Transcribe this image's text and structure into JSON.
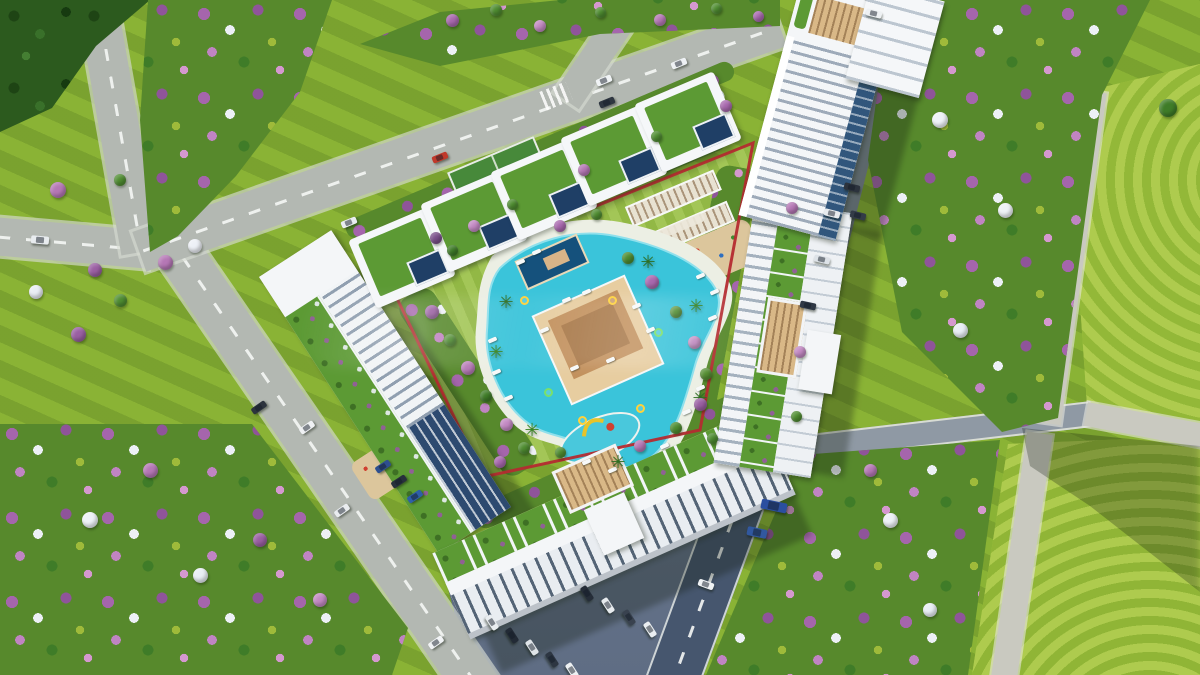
{
  "scene": {
    "type": "aerial-architectural-render",
    "label": "Bird's-eye 3D render of a triangular residential complex: a red property boundary encloses a landscaped garden with a free-form turquoise pool, pool bar, sports court, pergolas and playgrounds; a row of villas with green roofs lines the north-west edge, three white apartment blocks with roof gardens frame the site, a high-rise tower stands at the top right, all surrounded by roads with cars and fields of purple, pink, white and green flowering trees",
    "watermark_visible": true
  },
  "palette": {
    "lawn": "#8ab335",
    "lawn_sunlit": "#a8c944",
    "road": "#b3b8b2",
    "road_shaded": "#46566e",
    "path": "#c9c9c0",
    "building_white": "#f4f6f8",
    "glass_blue": "#2d4a70",
    "roof_garden": "#5c9a34",
    "pool": "#3ac4da",
    "deck_tan": "#d9b887",
    "boundary_red": "#b42b30",
    "tree_green": "#4f8d31",
    "tree_purple": "#9a5fa2",
    "tree_pink": "#c389c3",
    "tree_white": "#edf0f6"
  },
  "sprites": {
    "groups": [
      {
        "name": "car",
        "class": "car",
        "host": "#sprite-layer",
        "w": 16,
        "h": 7,
        "items": [
          {
            "x": 440,
            "y": 157,
            "r": -22,
            "c": "#c0392b"
          },
          {
            "x": 349,
            "y": 222,
            "r": -22,
            "c": "#e9edf0"
          },
          {
            "x": 604,
            "y": 80,
            "r": -22,
            "c": "#f0f3f5"
          },
          {
            "x": 607,
            "y": 102,
            "r": -22,
            "c": "#2e3640"
          },
          {
            "x": 679,
            "y": 63,
            "r": -22,
            "c": "#eef1f4"
          },
          {
            "x": 40,
            "y": 240,
            "r": 5,
            "c": "#e8ecef",
            "w": 18,
            "h": 8
          },
          {
            "x": 259,
            "y": 407,
            "r": -35,
            "c": "#2c333d"
          },
          {
            "x": 307,
            "y": 427,
            "r": -35,
            "c": "#eff1f3"
          },
          {
            "x": 342,
            "y": 510,
            "r": -35,
            "c": "#e9ecef"
          },
          {
            "x": 436,
            "y": 642,
            "r": -35,
            "c": "#f1f3f5"
          },
          {
            "x": 874,
            "y": 13,
            "r": 14,
            "c": "#eef1f3"
          },
          {
            "x": 852,
            "y": 187,
            "r": 14,
            "c": "#2c333d"
          },
          {
            "x": 858,
            "y": 215,
            "r": 14,
            "c": "#333b47"
          },
          {
            "x": 832,
            "y": 213,
            "r": 14,
            "c": "#e8ebee"
          },
          {
            "x": 822,
            "y": 259,
            "r": 13,
            "c": "#dde2e7"
          },
          {
            "x": 808,
            "y": 305,
            "r": 12,
            "c": "#2f3845"
          },
          {
            "x": 706,
            "y": 584,
            "r": 20,
            "c": "#eff2f4"
          },
          {
            "x": 774,
            "y": 506,
            "r": 12,
            "c": "#2b4fa0",
            "w": 26,
            "h": 10
          },
          {
            "x": 757,
            "y": 532,
            "r": 12,
            "c": "#31589f",
            "w": 20,
            "h": 9
          },
          {
            "x": 492,
            "y": 622,
            "r": 57,
            "c": "#e9edf0"
          },
          {
            "x": 512,
            "y": 635,
            "r": 57,
            "c": "#222a35"
          },
          {
            "x": 532,
            "y": 647,
            "r": 57,
            "c": "#dfe4e8"
          },
          {
            "x": 552,
            "y": 659,
            "r": 57,
            "c": "#2d3642"
          },
          {
            "x": 572,
            "y": 670,
            "r": 57,
            "c": "#eef1f3"
          },
          {
            "x": 587,
            "y": 593,
            "r": 57,
            "c": "#252d38"
          },
          {
            "x": 608,
            "y": 605,
            "r": 57,
            "c": "#e7ebee"
          },
          {
            "x": 629,
            "y": 617,
            "r": 57,
            "c": "#39424f"
          },
          {
            "x": 650,
            "y": 629,
            "r": 57,
            "c": "#eaeef1"
          },
          {
            "x": 383,
            "y": 466,
            "r": -33,
            "c": "#2e4f8f"
          },
          {
            "x": 399,
            "y": 481,
            "r": -33,
            "c": "#27303c"
          },
          {
            "x": 415,
            "y": 496,
            "r": -33,
            "c": "#2e5fa8"
          }
        ]
      },
      {
        "name": "lounger",
        "class": "lounger",
        "host": "#sprite-layer",
        "w": 9,
        "h": 4,
        "r": -24,
        "items": [
          {
            "x": 520,
            "y": 262
          },
          {
            "x": 536,
            "y": 252
          },
          {
            "x": 700,
            "y": 276
          },
          {
            "x": 714,
            "y": 292
          },
          {
            "x": 712,
            "y": 318
          },
          {
            "x": 700,
            "y": 388
          },
          {
            "x": 686,
            "y": 412
          },
          {
            "x": 664,
            "y": 446
          },
          {
            "x": 612,
            "y": 470
          },
          {
            "x": 586,
            "y": 462
          },
          {
            "x": 508,
            "y": 398
          },
          {
            "x": 496,
            "y": 372
          },
          {
            "x": 492,
            "y": 340
          },
          {
            "x": 566,
            "y": 300
          },
          {
            "x": 586,
            "y": 292
          },
          {
            "x": 636,
            "y": 306
          },
          {
            "x": 650,
            "y": 330
          },
          {
            "x": 610,
            "y": 360
          },
          {
            "x": 574,
            "y": 368
          },
          {
            "x": 544,
            "y": 330
          }
        ]
      },
      {
        "name": "pool-float",
        "class": "float",
        "host": "#sprite-layer",
        "w": 9,
        "h": 9,
        "prop": "border",
        "items": [
          {
            "x": 612,
            "y": 300,
            "c": "#ffd23a"
          },
          {
            "x": 658,
            "y": 332,
            "c": "#7ae06a"
          },
          {
            "x": 582,
            "y": 420,
            "c": "#ffd23a"
          },
          {
            "x": 640,
            "y": 408,
            "c": "#ffd23a"
          },
          {
            "x": 548,
            "y": 392,
            "c": "#7ae06a"
          },
          {
            "x": 524,
            "y": 300,
            "c": "#ffd23a"
          }
        ]
      },
      {
        "name": "palm-tree",
        "class": "palm",
        "host": "#sprite-layer",
        "w": 18,
        "h": 18,
        "glyph": "✳",
        "color": "#2d6e22",
        "items": [
          {
            "x": 506,
            "y": 302,
            "c": "#2d6e22"
          },
          {
            "x": 496,
            "y": 352,
            "c": "#35821f"
          },
          {
            "x": 648,
            "y": 262,
            "c": "#2d6e22"
          },
          {
            "x": 696,
            "y": 306,
            "c": "#35821f"
          },
          {
            "x": 618,
            "y": 462,
            "c": "#2d6e22"
          },
          {
            "x": 532,
            "y": 430,
            "c": "#35821f"
          },
          {
            "x": 700,
            "y": 398,
            "c": "#2d6e22"
          }
        ]
      },
      {
        "name": "tree",
        "class": "tree",
        "host": "#sprite-layer",
        "w": 12,
        "h": 12,
        "items": [
          {
            "x": 432,
            "y": 312,
            "c": "#9a5fa2",
            "w": 14
          },
          {
            "x": 450,
            "y": 340,
            "c": "#4f8d31",
            "w": 12
          },
          {
            "x": 468,
            "y": 368,
            "c": "#b577b5",
            "w": 14
          },
          {
            "x": 486,
            "y": 396,
            "c": "#3f7c28",
            "w": 12
          },
          {
            "x": 506,
            "y": 424,
            "c": "#c389c3",
            "w": 13
          },
          {
            "x": 524,
            "y": 448,
            "c": "#4f8d31",
            "w": 12
          },
          {
            "x": 628,
            "y": 258,
            "c": "#4e8c30",
            "w": 12
          },
          {
            "x": 652,
            "y": 282,
            "c": "#a868ae",
            "w": 14
          },
          {
            "x": 676,
            "y": 312,
            "c": "#4f8d31",
            "w": 12
          },
          {
            "x": 694,
            "y": 342,
            "c": "#c08ac0",
            "w": 13
          },
          {
            "x": 706,
            "y": 374,
            "c": "#568f33",
            "w": 12
          },
          {
            "x": 700,
            "y": 404,
            "c": "#9a5fa2",
            "w": 13
          },
          {
            "x": 676,
            "y": 428,
            "c": "#4e8c30",
            "w": 12
          },
          {
            "x": 560,
            "y": 226,
            "c": "#a868ae",
            "w": 12
          },
          {
            "x": 596,
            "y": 214,
            "c": "#4f8d31",
            "w": 11
          },
          {
            "x": 474,
            "y": 226,
            "c": "#c389c3",
            "w": 12
          },
          {
            "x": 452,
            "y": 250,
            "c": "#3f7c28",
            "w": 11
          },
          {
            "x": 436,
            "y": 238,
            "c": "#7a4f8a",
            "w": 12
          },
          {
            "x": 512,
            "y": 204,
            "c": "#4f8d31",
            "w": 11
          },
          {
            "x": 584,
            "y": 170,
            "c": "#b577b5",
            "w": 12
          },
          {
            "x": 656,
            "y": 136,
            "c": "#4f8d31",
            "w": 11
          },
          {
            "x": 726,
            "y": 106,
            "c": "#a868ae",
            "w": 12
          },
          {
            "x": 58,
            "y": 190,
            "c": "#b577b5",
            "w": 16
          },
          {
            "x": 36,
            "y": 292,
            "c": "#e9edf4",
            "w": 14
          },
          {
            "x": 78,
            "y": 334,
            "c": "#9a5fa2",
            "w": 15
          },
          {
            "x": 120,
            "y": 180,
            "c": "#4f8d31",
            "w": 12
          },
          {
            "x": 95,
            "y": 270,
            "c": "#9a5fa2",
            "w": 14
          },
          {
            "x": 120,
            "y": 300,
            "c": "#4f8d31",
            "w": 13
          },
          {
            "x": 452,
            "y": 20,
            "c": "#a868ae",
            "w": 13
          },
          {
            "x": 496,
            "y": 10,
            "c": "#4f8d31",
            "w": 12
          },
          {
            "x": 540,
            "y": 26,
            "c": "#c389c3",
            "w": 12
          },
          {
            "x": 600,
            "y": 12,
            "c": "#4e8c30",
            "w": 11
          },
          {
            "x": 660,
            "y": 20,
            "c": "#b577b5",
            "w": 12
          },
          {
            "x": 716,
            "y": 8,
            "c": "#4f8d31",
            "w": 11
          },
          {
            "x": 758,
            "y": 16,
            "c": "#a868ae",
            "w": 11
          },
          {
            "x": 792,
            "y": 208,
            "c": "#b577b5",
            "w": 12
          },
          {
            "x": 800,
            "y": 352,
            "c": "#c389c3",
            "w": 12
          },
          {
            "x": 796,
            "y": 416,
            "c": "#4f8d31",
            "w": 11
          },
          {
            "x": 500,
            "y": 462,
            "c": "#a868ae",
            "w": 12
          },
          {
            "x": 560,
            "y": 452,
            "c": "#4f8d31",
            "w": 11
          },
          {
            "x": 640,
            "y": 446,
            "c": "#b577b5",
            "w": 12
          },
          {
            "x": 712,
            "y": 438,
            "c": "#4e8c30",
            "w": 11
          },
          {
            "x": 940,
            "y": 120,
            "c": "#eef2f7",
            "w": 16
          },
          {
            "x": 1005,
            "y": 210,
            "c": "#eef2f7",
            "w": 15
          },
          {
            "x": 960,
            "y": 330,
            "c": "#e9eef5",
            "w": 15
          },
          {
            "x": 890,
            "y": 520,
            "c": "#edf1f6",
            "w": 15
          },
          {
            "x": 930,
            "y": 610,
            "c": "#e9eef5",
            "w": 14
          },
          {
            "x": 90,
            "y": 520,
            "c": "#eef2f7",
            "w": 16
          },
          {
            "x": 200,
            "y": 575,
            "c": "#e9eef5",
            "w": 15
          },
          {
            "x": 150,
            "y": 470,
            "c": "#b577b5",
            "w": 15
          },
          {
            "x": 260,
            "y": 540,
            "c": "#9a5fa2",
            "w": 14
          },
          {
            "x": 320,
            "y": 600,
            "c": "#c389c3",
            "w": 14
          },
          {
            "x": 165,
            "y": 262,
            "c": "#b577b5",
            "w": 15
          },
          {
            "x": 195,
            "y": 246,
            "c": "#edf0f6",
            "w": 14
          },
          {
            "x": 1168,
            "y": 108,
            "c": "#3f7c28",
            "w": 18
          },
          {
            "x": 870,
            "y": 470,
            "c": "#b577b5",
            "w": 13
          }
        ]
      }
    ]
  }
}
